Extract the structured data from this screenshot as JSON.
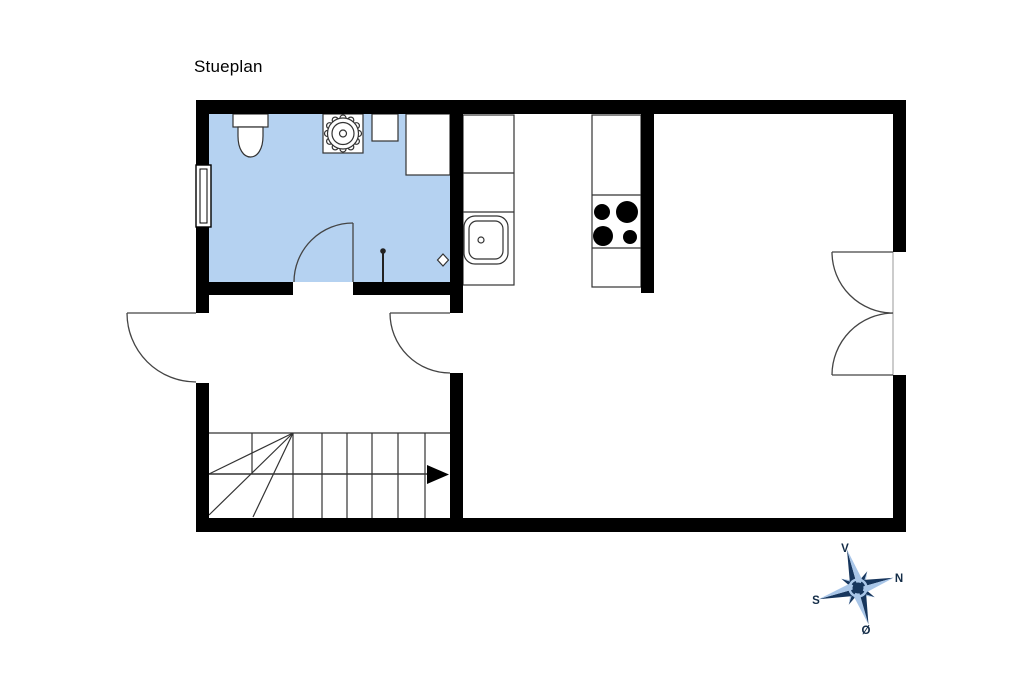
{
  "title": "Stueplan",
  "plan": {
    "room_fill": "#b5d2f1",
    "wall_color": "#000000",
    "line_color": "#333333",
    "rooms": [
      "bathroom",
      "kitchen",
      "hallway",
      "living-room"
    ],
    "fixtures": [
      "toilet",
      "washing-machine",
      "cabinet",
      "corner-cabinet",
      "shower-screen",
      "floor-drain",
      "kitchen-counter",
      "kitchen-sink",
      "stove-4-burners",
      "window",
      "stairs-with-direction-arrow"
    ],
    "doors": [
      "bathroom-door",
      "hallway-kitchen-door",
      "entrance-door",
      "living-room-double-door"
    ]
  },
  "compass": {
    "dark": "#17365d",
    "light": "#a9c6e8",
    "labels": {
      "up": "V",
      "right": "N",
      "left": "S",
      "down": "Ø"
    }
  }
}
